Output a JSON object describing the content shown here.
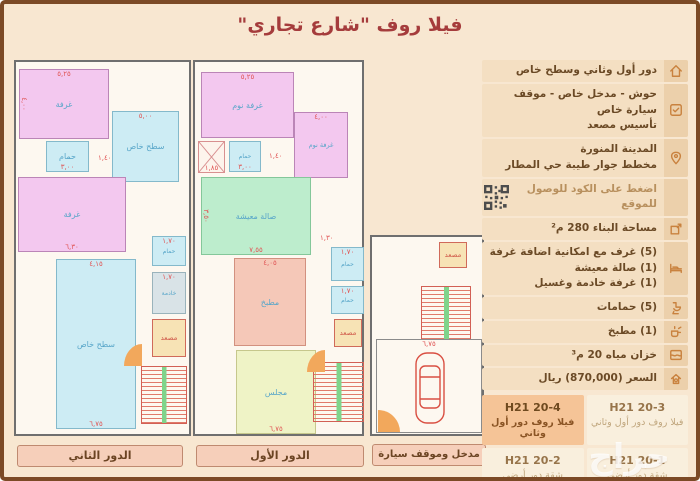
{
  "title": "فيلا روف \"شارع تجاري\"",
  "sidebar": {
    "rows": {
      "floors": {
        "text": "دور أول وثاني وسطح خاص"
      },
      "features": {
        "line1": "حوش - مدخل خاص - موقف سيارة خاص",
        "line2": "تأسيس مصعد"
      },
      "location": {
        "line1": "المدينة المنورة",
        "line2": "مخطط جوار طيبة حي المطار"
      },
      "qr": {
        "text": "اضغط على الكود للوصول للموقع"
      },
      "area": {
        "text": "مساحة البناء 280 م²"
      },
      "rooms": {
        "line1": "(5) غرف مع امكانية اضافة غرفة",
        "line2": "(1) صالة معيشة",
        "line3": "(1) غرفة خادمة وغسيل"
      },
      "bathrooms": {
        "text": "(5) حمامات"
      },
      "kitchen": {
        "text": "(1) مطبخ"
      },
      "tank": {
        "text": "خزان مياه 20 م³"
      },
      "price": {
        "text": "السعر (870,000) ريال"
      }
    },
    "units": {
      "u4": {
        "code": "H21 20-4",
        "desc": "فيلا روف دور أول وثاني"
      },
      "u3": {
        "code": "H21 20-3",
        "desc": "فيلا روف دور أول وثاني"
      },
      "u2": {
        "code": "H21 20-2",
        "desc": "شقة دور أرضي"
      },
      "u1": {
        "code": "H21 20-1",
        "desc": "شقة دور أرضي"
      }
    }
  },
  "plans": {
    "second_floor": {
      "caption": "الدور الثاني",
      "rooms": {
        "bedroom_top": {
          "label": "غرفة",
          "dim_top": "٥,٢٥",
          "dim_left": "٤,٠٠"
        },
        "bath": {
          "label": "حمام",
          "dim": "٣,٠٠"
        },
        "roof_top": {
          "label": "سطح خاص",
          "dim_top": "٥,٠٠"
        },
        "bedroom_mid": {
          "label": "غرفة",
          "dim_bottom": "٦,٣٠"
        },
        "roof_big": {
          "label": "سطح خاص",
          "dim_top": "٤,١٥",
          "dim_bottom": "٦,٧٥"
        },
        "bath_small": {
          "label": "حمام",
          "dim": "١,٧٠"
        },
        "maid": {
          "label": "خادمة",
          "dim": "١,٧٠"
        },
        "elevator": {
          "label": "مصعد"
        },
        "hall": {
          "dim": "١,٤٠"
        }
      }
    },
    "first_floor": {
      "caption": "الدور الأول",
      "rooms": {
        "bedroom_top": {
          "label": "غرفة نوم",
          "dim_top": "٥,٢٥"
        },
        "shaft": {
          "dim": "١,٨٥"
        },
        "bath": {
          "label": "حمام",
          "dim": "٣,٠٠"
        },
        "bedroom_right": {
          "label": "غرفة نوم",
          "dim_top": "٤,٠٠"
        },
        "living": {
          "label": "صالة معيشة",
          "dim_bottom": "٧,٥٥",
          "dim_left": "٣,٥٠"
        },
        "kitchen": {
          "label": "مطبخ",
          "dim_top": "٤,٠٥"
        },
        "majlis": {
          "label": "مجلس",
          "dim_bottom": "٦,٧٥"
        },
        "bath1": {
          "label": "حمام",
          "dim": "١,٧٠"
        },
        "bath2": {
          "label": "حمام",
          "dim": "١,٧٠"
        },
        "elevator": {
          "label": "مصعد"
        },
        "hall1": {
          "dim": "١,٤٠"
        },
        "hall2": {
          "dim": "١,٣٠"
        }
      }
    },
    "entrance": {
      "caption": "مدخل وموقف سيارة",
      "rooms": {
        "elevator": {
          "label": "مصعد"
        },
        "parking": {
          "dim_top": "٦,٧٥"
        }
      }
    }
  },
  "watermark": "حراج"
}
